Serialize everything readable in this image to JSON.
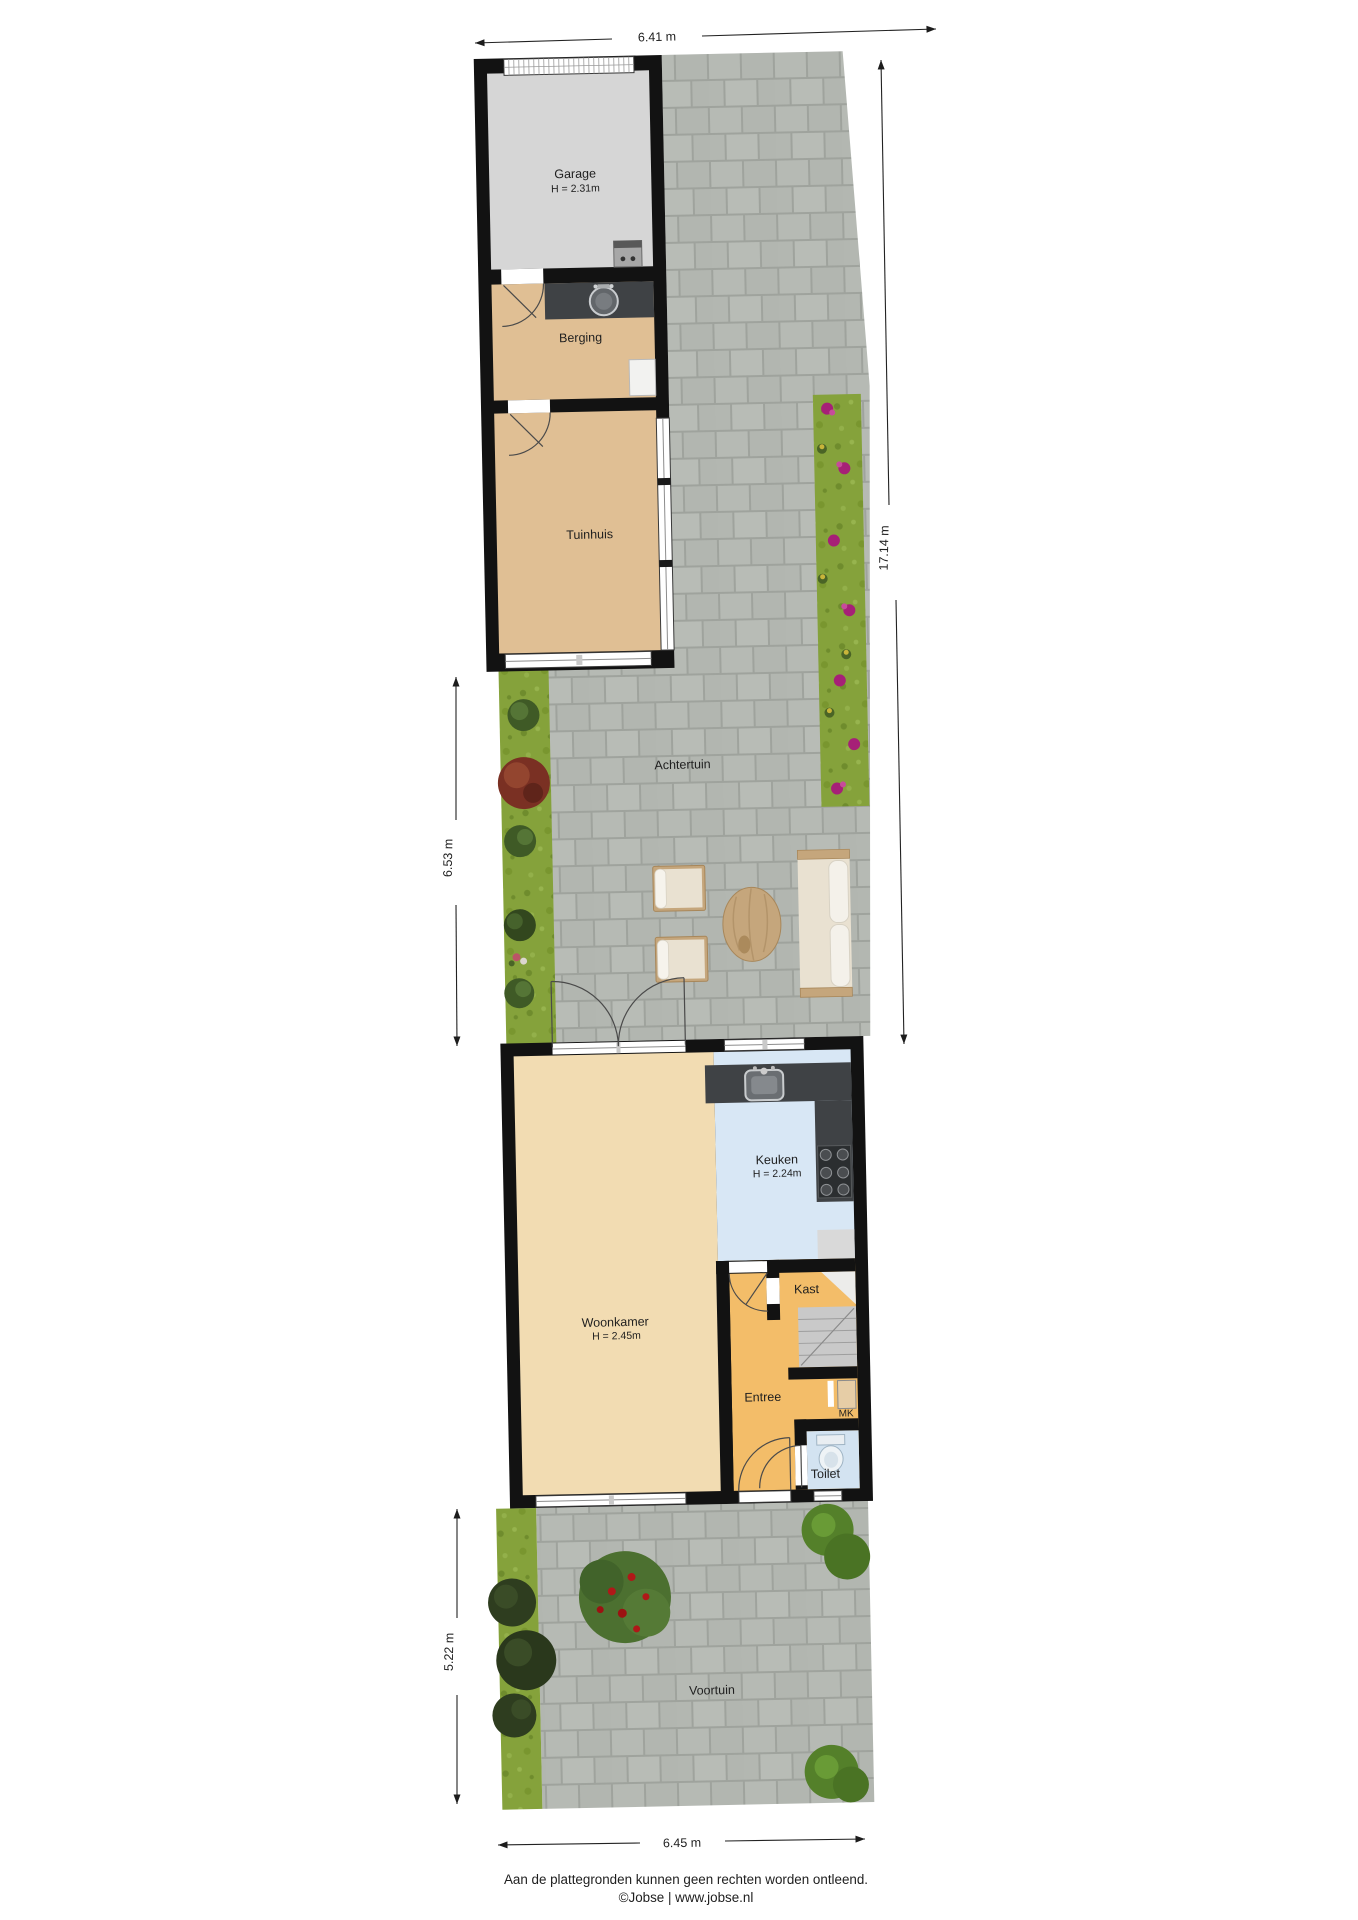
{
  "plan_title": "floorplan-with-garden",
  "rooms": {
    "garage": {
      "name": "Garage",
      "height": "H = 2.31m"
    },
    "berging": {
      "name": "Berging"
    },
    "tuinhuis": {
      "name": "Tuinhuis"
    },
    "keuken": {
      "name": "Keuken",
      "height": "H = 2.24m"
    },
    "woonkamer": {
      "name": "Woonkamer",
      "height": "H = 2.45m"
    },
    "kast": {
      "name": "Kast"
    },
    "entree": {
      "name": "Entree"
    },
    "mk": {
      "name": "MK"
    },
    "toilet": {
      "name": "Toilet"
    }
  },
  "areas": {
    "achtertuin": "Achtertuin",
    "voortuin": "Voortuin"
  },
  "dimensions": {
    "top": "6.41 m",
    "right": "17.14 m",
    "garden_left": "6.53 m",
    "front_left": "5.22 m",
    "bottom": "6.45 m"
  },
  "footer": {
    "disclaimer": "Aan de plattegronden kunnen geen rechten worden ontleend.",
    "credit": "©Jobse | www.jobse.nl"
  },
  "colors": {
    "walls": "#121212",
    "garage_floor": "#d6d6d6",
    "shed_floor": "#e0bf94",
    "living_floor": "#f2dcb2",
    "kitchen_floor": "#d8e7f5",
    "hall_floor": "#f3bd69",
    "toilet_floor": "#d3e3f1",
    "stairs": "#c9c9c9",
    "counter": "#3f4245",
    "appliance_gray": "#d9d9d9",
    "pavement_block": "#b6bab4",
    "pavement_joint": "#999d97",
    "grass": "#85a23b",
    "wood": "#c5a67c",
    "cushion": "#e9e1d1"
  }
}
